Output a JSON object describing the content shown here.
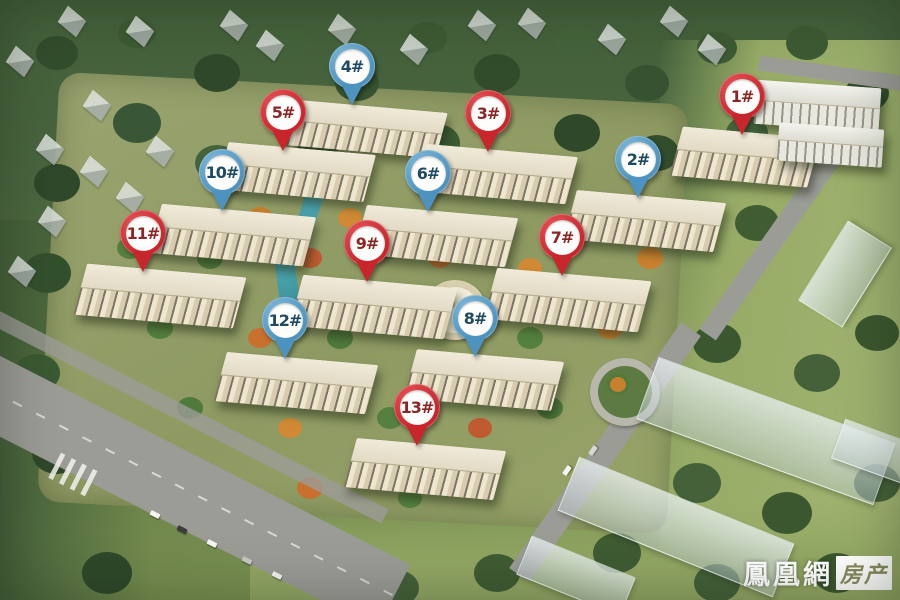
{
  "markers": [
    {
      "label": "1#",
      "color": "red",
      "x": 742,
      "y": 137
    },
    {
      "label": "2#",
      "color": "blue",
      "x": 638,
      "y": 200
    },
    {
      "label": "3#",
      "color": "red",
      "x": 488,
      "y": 154
    },
    {
      "label": "4#",
      "color": "blue",
      "x": 352,
      "y": 107
    },
    {
      "label": "5#",
      "color": "red",
      "x": 283,
      "y": 153
    },
    {
      "label": "6#",
      "color": "blue",
      "x": 428,
      "y": 214
    },
    {
      "label": "7#",
      "color": "red",
      "x": 562,
      "y": 278
    },
    {
      "label": "8#",
      "color": "blue",
      "x": 475,
      "y": 359
    },
    {
      "label": "9#",
      "color": "red",
      "x": 367,
      "y": 284
    },
    {
      "label": "10#",
      "color": "blue",
      "x": 222,
      "y": 213
    },
    {
      "label": "11#",
      "color": "red",
      "x": 143,
      "y": 274
    },
    {
      "label": "12#",
      "color": "blue",
      "x": 285,
      "y": 361
    },
    {
      "label": "13#",
      "color": "red",
      "x": 417,
      "y": 448
    }
  ],
  "marker_style": {
    "red": "#c9252c",
    "red_light": "#e4555a",
    "red_text": "#8c2626",
    "blue": "#4e93bf",
    "blue_light": "#7fb9d9",
    "blue_text": "#1f4a63"
  },
  "watermark": {
    "site_name": "鳳凰網",
    "channel": "房产"
  }
}
